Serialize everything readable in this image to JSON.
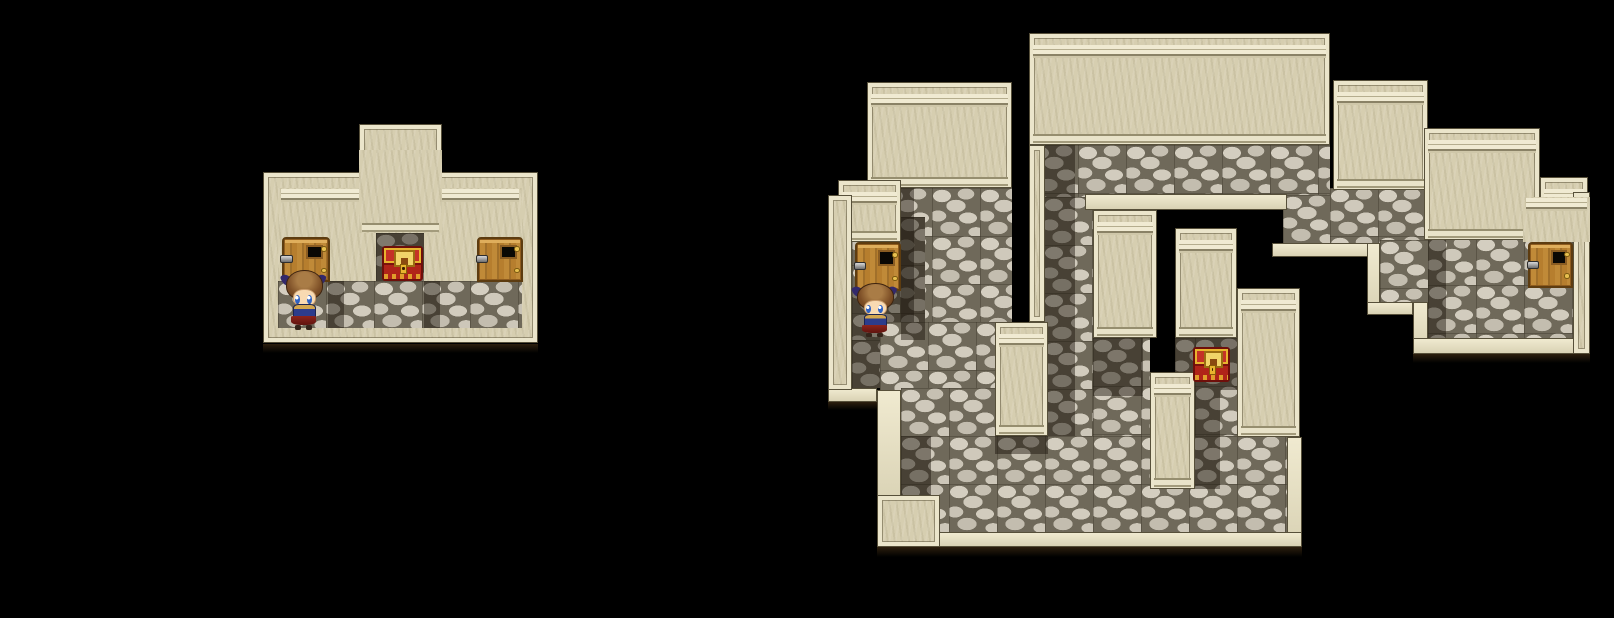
{
  "palette": {
    "bg": "#000000",
    "wallFace": "#d6ceb0",
    "wallRim": "#ebe5cb",
    "wallEdge": "#57503a",
    "corniceHi": "#f0ead2",
    "corniceDk": "#8a8266",
    "stoneGap": "#6f695a",
    "stoneA": "#d4cec0",
    "stoneB": "#c6c0b2",
    "stoneC": "#cfc9bb",
    "shadowTint": "rgba(24,18,8,0.45)",
    "doorWood": "#c08a38",
    "doorFrame": "#5d3c10",
    "chestRed": "#b02419",
    "chestGold": "#e8b42e",
    "charHair": "#7c4e26",
    "charSkin": "#f8dab2",
    "charEye": "#2f62c4",
    "charBlue": "#2c3c8c",
    "charGold": "#d2a64e",
    "charCape": "#8e241c",
    "charRibbon": "#33296b"
  },
  "maps": [
    {
      "id": "small-room",
      "shapes": [
        {
          "t": "plain",
          "n": "outer-wall-main",
          "x": 263,
          "y": 172,
          "w": 275,
          "h": 171
        },
        {
          "t": "plain",
          "n": "outer-wall-tower",
          "x": 359,
          "y": 124,
          "w": 83,
          "h": 66
        },
        {
          "t": "face",
          "n": "inner-wall-face",
          "x": 278,
          "y": 188,
          "w": 244,
          "h": 93
        },
        {
          "t": "faceb",
          "n": "tower-column-face",
          "x": 359,
          "y": 150,
          "w": 83,
          "h": 83
        },
        {
          "t": "stone",
          "n": "alcove-floor",
          "x": 376,
          "y": 233,
          "w": 48,
          "h": 48
        },
        {
          "t": "dark",
          "n": "alcove-shadow",
          "x": 376,
          "y": 233,
          "w": 48,
          "h": 48
        },
        {
          "t": "stone",
          "n": "room-floor",
          "x": 278,
          "y": 281,
          "w": 244,
          "h": 47
        },
        {
          "t": "dark",
          "n": "floor-shadow-left",
          "x": 328,
          "y": 281,
          "w": 16,
          "h": 47
        },
        {
          "t": "dark",
          "n": "floor-shadow-right",
          "x": 424,
          "y": 281,
          "w": 16,
          "h": 47
        },
        {
          "t": "shadow",
          "n": "map-drop-shadow",
          "x": 263,
          "y": 344,
          "w": 275,
          "h": 9
        }
      ],
      "sprites": [
        {
          "kind": "door",
          "n": "door-left",
          "x": 282,
          "y": 237,
          "w": 48,
          "h": 45
        },
        {
          "kind": "chest",
          "n": "treasure-chest",
          "x": 382,
          "y": 246,
          "w": 41,
          "h": 35
        },
        {
          "kind": "door",
          "n": "door-right",
          "x": 477,
          "y": 237,
          "w": 46,
          "h": 45
        },
        {
          "kind": "char",
          "n": "player-character",
          "x": 285,
          "y": 270,
          "w": 37,
          "h": 60
        }
      ]
    },
    {
      "id": "large-dungeon",
      "shapes": [
        {
          "t": "stone",
          "n": "floor-under-big-block",
          "x": 1030,
          "y": 145,
          "w": 300,
          "h": 52
        },
        {
          "t": "stone",
          "n": "floor-nub",
          "x": 1283,
          "y": 195,
          "w": 47,
          "h": 48
        },
        {
          "t": "stone",
          "n": "floor-under-step1",
          "x": 1330,
          "y": 188,
          "w": 98,
          "h": 55
        },
        {
          "t": "stone",
          "n": "floor-right-room",
          "x": 1428,
          "y": 237,
          "w": 145,
          "h": 101
        },
        {
          "t": "stone",
          "n": "floor-right-ledge",
          "x": 1380,
          "y": 240,
          "w": 48,
          "h": 64
        },
        {
          "t": "stone",
          "n": "corridor-upper",
          "x": 884,
          "y": 188,
          "w": 128,
          "h": 134
        },
        {
          "t": "stone",
          "n": "alcove-floor",
          "x": 852,
          "y": 217,
          "w": 73,
          "h": 123
        },
        {
          "t": "stone",
          "n": "corridor-mid",
          "x": 852,
          "y": 340,
          "w": 160,
          "h": 48
        },
        {
          "t": "stone",
          "n": "corridor-lower",
          "x": 880,
          "y": 322,
          "w": 115,
          "h": 114
        },
        {
          "t": "stone",
          "n": "corridor-lower-2",
          "x": 901,
          "y": 388,
          "w": 94,
          "h": 48
        },
        {
          "t": "stone",
          "n": "strip-under-block",
          "x": 1044,
          "y": 197,
          "w": 49,
          "h": 239
        },
        {
          "t": "stone",
          "n": "floor-under-t-left",
          "x": 1093,
          "y": 338,
          "w": 57,
          "h": 98
        },
        {
          "t": "stone",
          "n": "floor-chest-area",
          "x": 1195,
          "y": 338,
          "w": 42,
          "h": 98
        },
        {
          "t": "stone",
          "n": "floor-under-t-right",
          "x": 1175,
          "y": 338,
          "w": 20,
          "h": 34
        },
        {
          "t": "stone",
          "n": "floor-bottom-hall",
          "x": 901,
          "y": 436,
          "w": 386,
          "h": 96
        },
        {
          "t": "dark",
          "n": "shadow-corridor-left",
          "x": 884,
          "y": 188,
          "w": 30,
          "h": 134
        },
        {
          "t": "dark",
          "n": "shadow-alcove",
          "x": 901,
          "y": 217,
          "w": 24,
          "h": 123
        },
        {
          "t": "dark",
          "n": "shadow-corridor-left-2",
          "x": 852,
          "y": 291,
          "w": 28,
          "h": 97
        },
        {
          "t": "dark",
          "n": "shadow-under-block-left",
          "x": 1044,
          "y": 145,
          "w": 31,
          "h": 291
        },
        {
          "t": "dark",
          "n": "shadow-chest-area",
          "x": 1175,
          "y": 338,
          "w": 62,
          "h": 52
        },
        {
          "t": "dark",
          "n": "shadow-under-t-left",
          "x": 1093,
          "y": 338,
          "w": 50,
          "h": 58
        },
        {
          "t": "dark",
          "n": "shadow-right-of-pillar",
          "x": 1195,
          "y": 390,
          "w": 25,
          "h": 99
        },
        {
          "t": "dark",
          "n": "shadow-bottom-left",
          "x": 901,
          "y": 436,
          "w": 30,
          "h": 59
        },
        {
          "t": "dark",
          "n": "shadow-right-room",
          "x": 1428,
          "y": 237,
          "w": 18,
          "h": 101
        },
        {
          "t": "dark",
          "n": "shadow-under-pillar-a",
          "x": 995,
          "y": 436,
          "w": 53,
          "h": 18
        },
        {
          "t": "rim",
          "n": "hole-top-ledge",
          "x": 1085,
          "y": 194,
          "w": 202,
          "h": 16
        },
        {
          "t": "rim",
          "n": "stair-ledge-1",
          "x": 1272,
          "y": 243,
          "w": 108,
          "h": 14
        },
        {
          "t": "rim",
          "n": "stair-ledge-2",
          "x": 1367,
          "y": 243,
          "w": 13,
          "h": 72
        },
        {
          "t": "rim",
          "n": "stair-ledge-3",
          "x": 1367,
          "y": 302,
          "w": 46,
          "h": 13
        },
        {
          "t": "rim",
          "n": "stair-ledge-4",
          "x": 1413,
          "y": 302,
          "w": 15,
          "h": 50
        },
        {
          "t": "rim",
          "n": "right-bottom-ledge",
          "x": 1413,
          "y": 338,
          "w": 177,
          "h": 16
        },
        {
          "t": "rim",
          "n": "left-step-ledge",
          "x": 828,
          "y": 388,
          "w": 49,
          "h": 14
        },
        {
          "t": "rim",
          "n": "left-edge-strip",
          "x": 877,
          "y": 390,
          "w": 24,
          "h": 117
        },
        {
          "t": "rim",
          "n": "bottom-right-edge",
          "x": 1287,
          "y": 437,
          "w": 15,
          "h": 110
        },
        {
          "t": "rim",
          "n": "bottom-edge",
          "x": 901,
          "y": 532,
          "w": 401,
          "h": 15
        },
        {
          "t": "wall",
          "n": "pillar-column-top",
          "x": 867,
          "y": 82,
          "w": 145,
          "h": 106
        },
        {
          "t": "wall",
          "n": "big-block",
          "x": 1029,
          "y": 33,
          "w": 301,
          "h": 112
        },
        {
          "t": "plain",
          "n": "big-block-left-wall",
          "x": 1029,
          "y": 145,
          "w": 16,
          "h": 177
        },
        {
          "t": "wall",
          "n": "step-block-1",
          "x": 1333,
          "y": 80,
          "w": 95,
          "h": 110
        },
        {
          "t": "wall",
          "n": "step-block-2",
          "x": 1424,
          "y": 128,
          "w": 116,
          "h": 112
        },
        {
          "t": "wall",
          "n": "step-block-3",
          "x": 1540,
          "y": 177,
          "w": 48,
          "h": 63
        },
        {
          "t": "plain",
          "n": "right-edge-wall",
          "x": 1573,
          "y": 192,
          "w": 17,
          "h": 162
        },
        {
          "t": "face",
          "n": "wall-above-right-door",
          "x": 1523,
          "y": 197,
          "w": 67,
          "h": 45
        },
        {
          "t": "wall",
          "n": "alcove-top-wall",
          "x": 838,
          "y": 180,
          "w": 63,
          "h": 62
        },
        {
          "t": "plain",
          "n": "left-edge-wall",
          "x": 828,
          "y": 195,
          "w": 24,
          "h": 195
        },
        {
          "t": "wall",
          "n": "t-pillar-left",
          "x": 1093,
          "y": 210,
          "w": 64,
          "h": 128
        },
        {
          "t": "wall",
          "n": "t-pillar-right",
          "x": 1175,
          "y": 228,
          "w": 62,
          "h": 110
        },
        {
          "t": "wall",
          "n": "center-pillar",
          "x": 1150,
          "y": 372,
          "w": 45,
          "h": 117
        },
        {
          "t": "wall",
          "n": "right-pillar",
          "x": 1237,
          "y": 288,
          "w": 63,
          "h": 149
        },
        {
          "t": "wall",
          "n": "left-pillar",
          "x": 995,
          "y": 322,
          "w": 53,
          "h": 114
        },
        {
          "t": "plain",
          "n": "bottom-left-corner",
          "x": 877,
          "y": 495,
          "w": 63,
          "h": 52
        },
        {
          "t": "shadow",
          "n": "drop-bottom",
          "x": 877,
          "y": 547,
          "w": 425,
          "h": 10
        },
        {
          "t": "shadow",
          "n": "drop-right-room",
          "x": 1413,
          "y": 354,
          "w": 177,
          "h": 9
        },
        {
          "t": "shadow",
          "n": "drop-left-step",
          "x": 828,
          "y": 402,
          "w": 49,
          "h": 8
        }
      ],
      "sprites": [
        {
          "kind": "door",
          "n": "door-alcove",
          "x": 855,
          "y": 242,
          "w": 46,
          "h": 49
        },
        {
          "kind": "char",
          "n": "player-character",
          "x": 856,
          "y": 283,
          "w": 37,
          "h": 54
        },
        {
          "kind": "chest",
          "n": "treasure-chest",
          "x": 1193,
          "y": 347,
          "w": 37,
          "h": 35
        },
        {
          "kind": "door",
          "n": "door-far-right",
          "x": 1528,
          "y": 242,
          "w": 45,
          "h": 46
        }
      ]
    }
  ]
}
